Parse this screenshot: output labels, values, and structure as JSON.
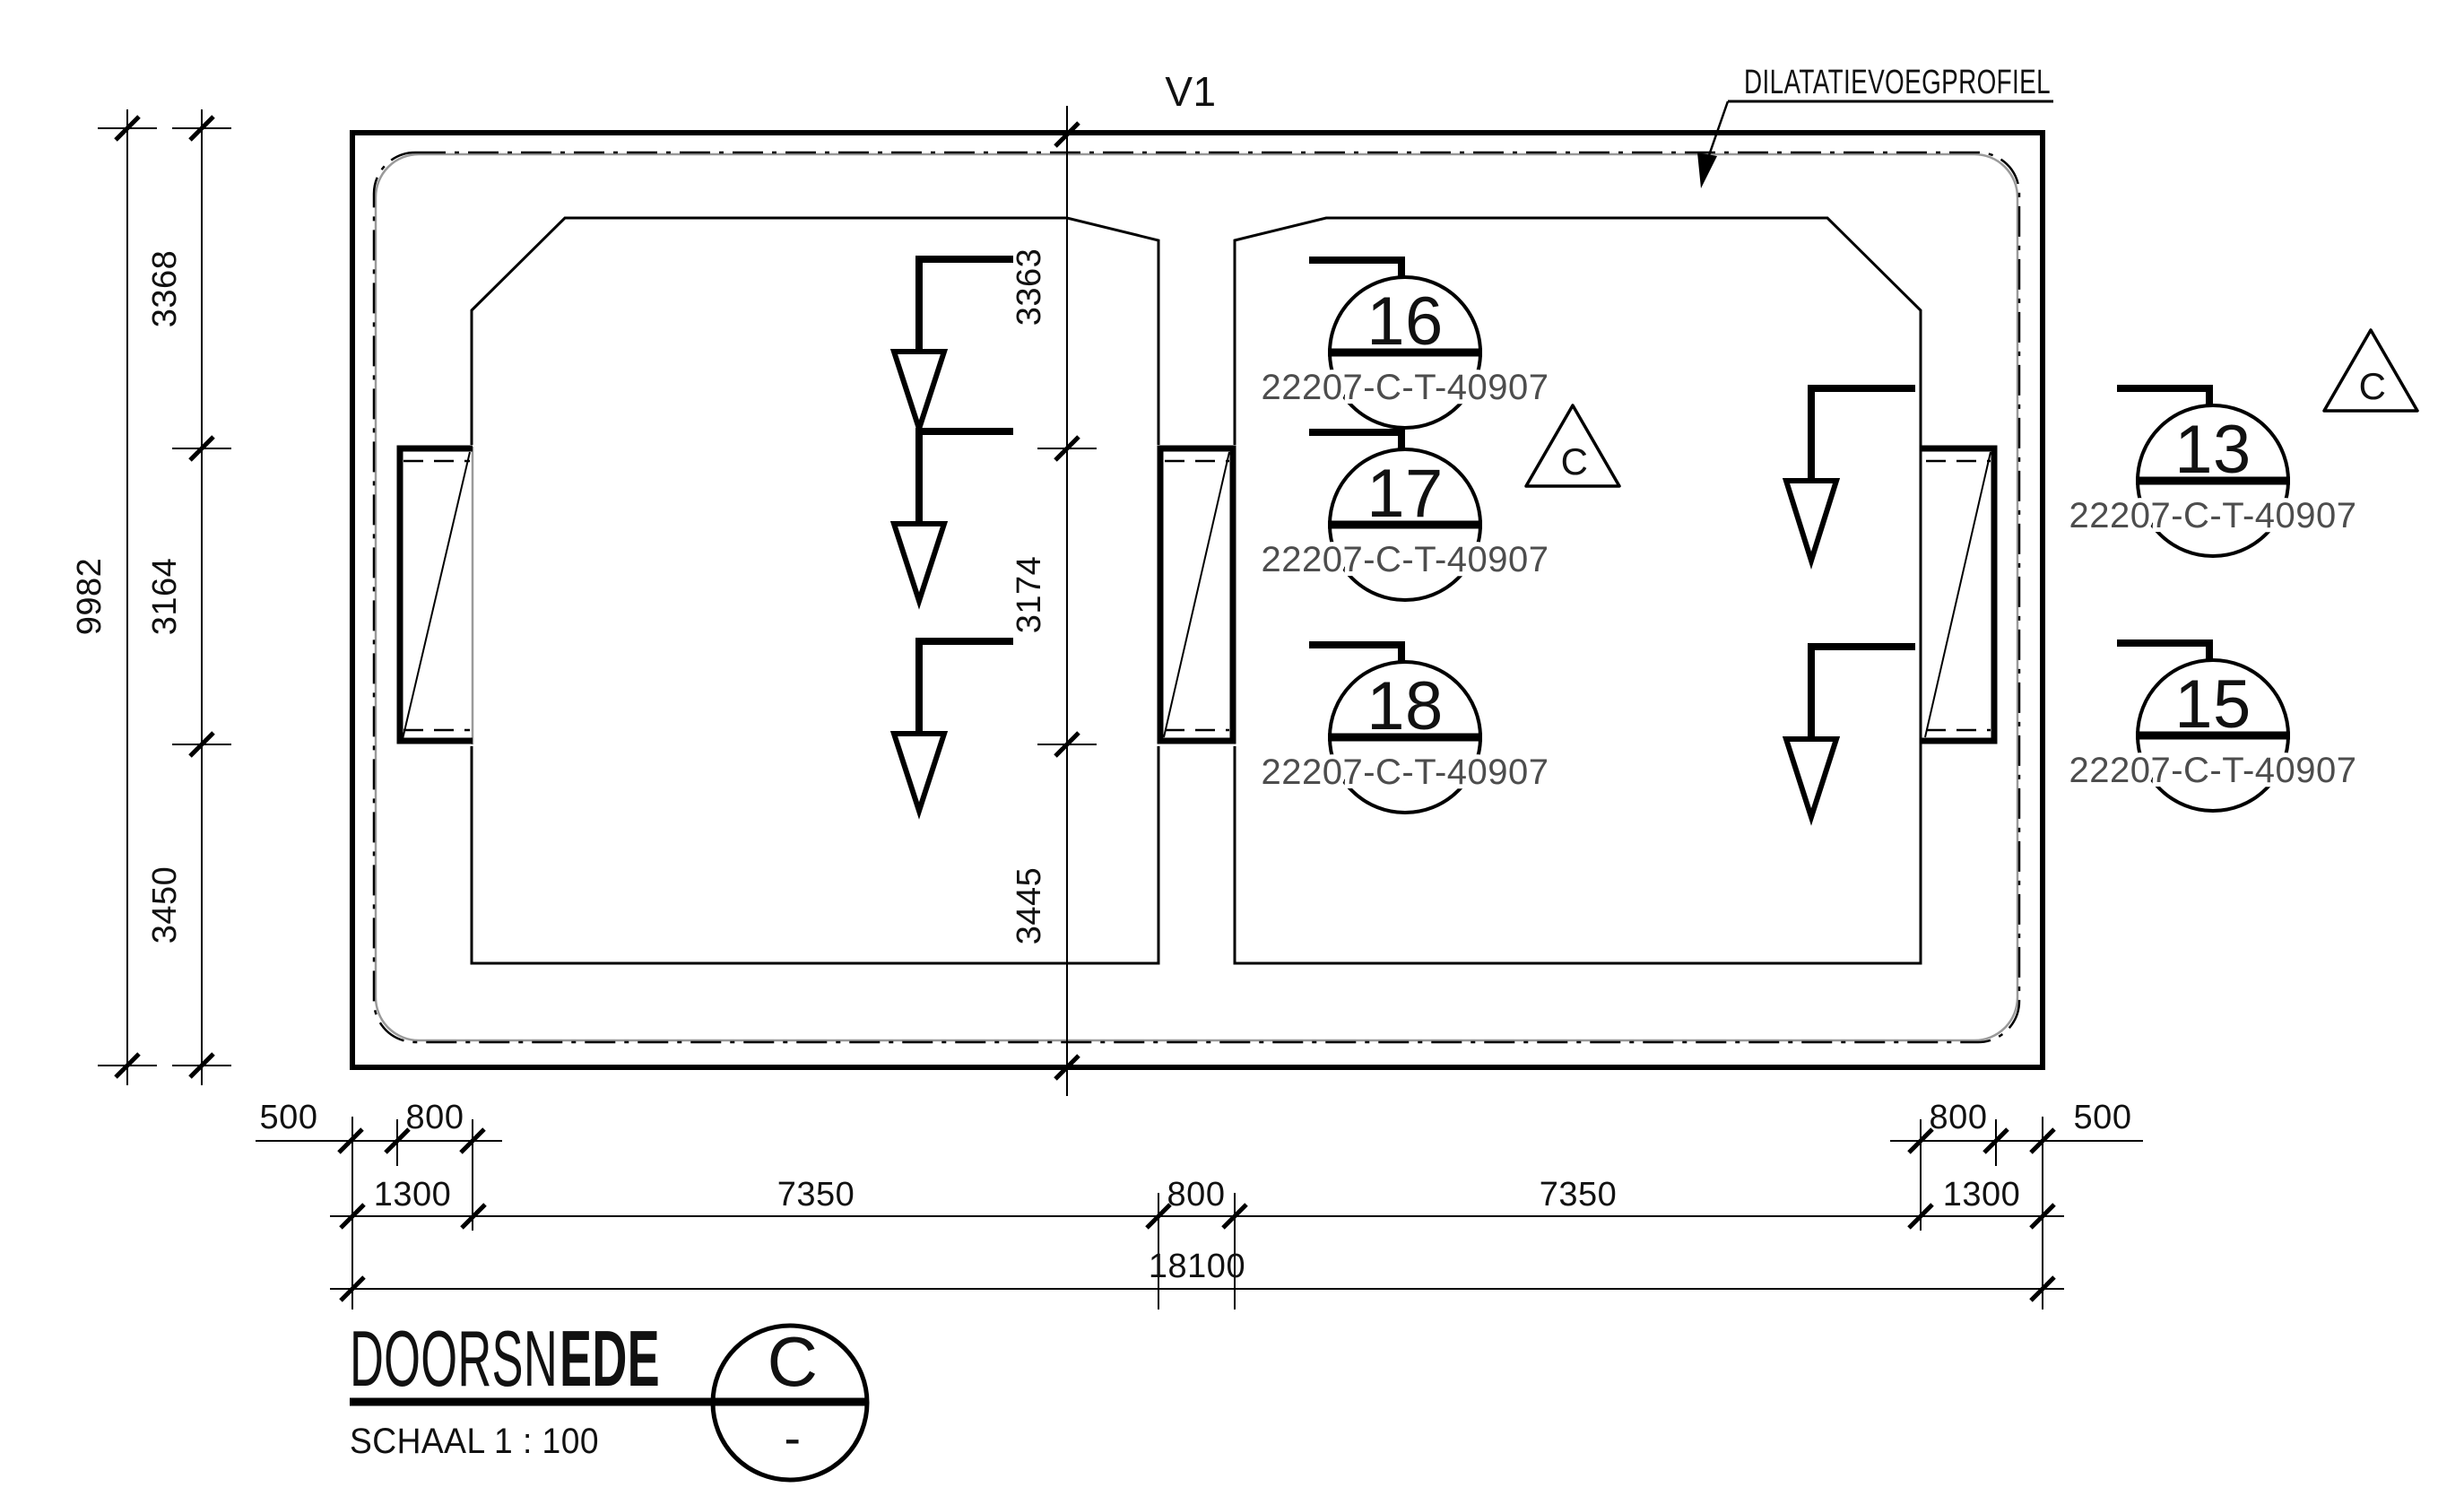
{
  "drawing": {
    "section_label": "V1",
    "callout": "DILATATIEVOEGPROFIEL",
    "title_regular": "DOORSN",
    "title_bold": "EDE",
    "title_full": "DOORSNEDE",
    "scale_label": "SCHAAL 1 : 100",
    "section_circle_top": "C",
    "section_circle_bottom": "-",
    "triangle_markers": [
      {
        "label": "C"
      },
      {
        "label": "C"
      }
    ],
    "line_color": "#000000",
    "accent_gray": "#9a9a9a"
  },
  "dimensions": {
    "left_total": "9982",
    "left_chain": [
      "3368",
      "3164",
      "3450"
    ],
    "middle_chain": [
      "3363",
      "3174",
      "3445"
    ],
    "bottom_row1_left": [
      "500",
      "800"
    ],
    "bottom_row1_right": [
      "800",
      "500"
    ],
    "bottom_row2": [
      "1300",
      "7350",
      "800",
      "7350",
      "1300"
    ],
    "bottom_total": "18100"
  },
  "part_tags": [
    {
      "number": "16",
      "code": "22207-C-T-40907"
    },
    {
      "number": "17",
      "code": "22207-C-T-40907"
    },
    {
      "number": "18",
      "code": "22207-C-T-40907"
    },
    {
      "number": "13",
      "code": "22207-C-T-40907"
    },
    {
      "number": "15",
      "code": "22207-C-T-40907"
    }
  ]
}
